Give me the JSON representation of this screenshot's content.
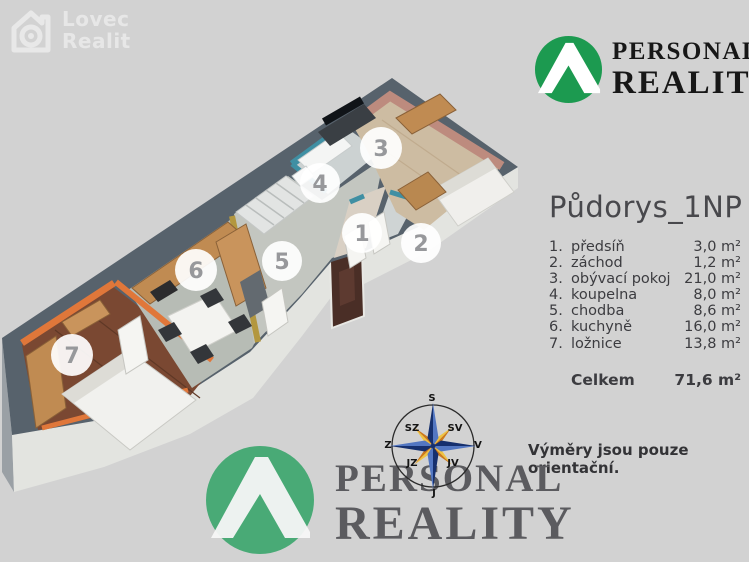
{
  "watermark": {
    "line1": "Lovec",
    "line2": "Realit"
  },
  "brand_top": {
    "word1": "PERSONAL",
    "word2": "REALITY"
  },
  "brand_bottom": {
    "word1": "PERSONAL",
    "word2": "REALITY"
  },
  "panel": {
    "title": "Půdorys_1NP",
    "rooms": [
      {
        "badge": "1",
        "num": "1.",
        "name": "předsíň",
        "area": "3,0 m²"
      },
      {
        "badge": "2",
        "num": "2.",
        "name": "záchod",
        "area": "1,2 m²"
      },
      {
        "badge": "3",
        "num": "3.",
        "name": "obývací pokoj",
        "area": "21,0 m²"
      },
      {
        "badge": "4",
        "num": "4.",
        "name": "koupelna",
        "area": "8,0 m²"
      },
      {
        "badge": "5",
        "num": "5.",
        "name": "chodba",
        "area": "8,6 m²"
      },
      {
        "badge": "6",
        "num": "6.",
        "name": "kuchyně",
        "area": "16,0 m²"
      },
      {
        "badge": "7",
        "num": "7.",
        "name": "ložnice",
        "area": "13,8 m²"
      }
    ],
    "total_label": "Celkem",
    "total_area": "71,6 m²"
  },
  "disclaimer": "Výměry jsou pouze orientační.",
  "compass": {
    "n": "S",
    "ne": "SV",
    "e": "V",
    "se": "JV",
    "s": "J",
    "sw": "JZ",
    "w": "Z",
    "nw": "SZ"
  },
  "colors": {
    "brand_green": "#1c9a50",
    "wall_top": "#57626c",
    "bedroom_orange": "#e0773a",
    "bathroom_teal": "#3f8fa3",
    "living_salmon": "#bd8b7e",
    "hall_yellow": "#b3973f",
    "background": "#d2d2d2"
  }
}
